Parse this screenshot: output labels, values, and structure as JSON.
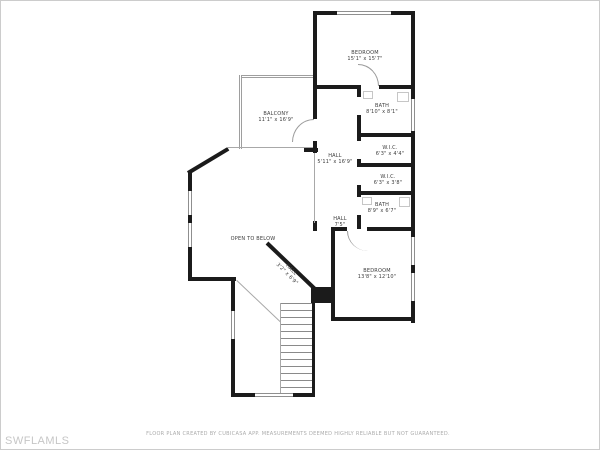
{
  "watermark": "SWFLAMLS",
  "disclaimer": "FLOOR PLAN CREATED BY CUBICASA APP. MEASUREMENTS DEEMED HIGHLY RELIABLE BUT NOT GUARANTEED.",
  "rooms": [
    {
      "id": "bedroom-upper",
      "name": "BEDROOM",
      "dims": "15'1\" x 15'7\""
    },
    {
      "id": "bath-upper",
      "name": "BATH",
      "dims": "8'10\" x 8'1\""
    },
    {
      "id": "wic-1",
      "name": "W.I.C.",
      "dims": "6'3\" x 4'4\""
    },
    {
      "id": "wic-2",
      "name": "W.I.C.",
      "dims": "6'3\" x 3'8\""
    },
    {
      "id": "bath-lower",
      "name": "BATH",
      "dims": "8'9\" x 6'7\""
    },
    {
      "id": "hall-main",
      "name": "HALL",
      "dims": "5'11\" x 16'9\""
    },
    {
      "id": "hall-small",
      "name": "HALL",
      "dims": "7'5\""
    },
    {
      "id": "bedroom-lower",
      "name": "BEDROOM",
      "dims": "13'8\" x 12'10\""
    },
    {
      "id": "balcony",
      "name": "BALCONY",
      "dims": "11'1\" x 16'9\""
    },
    {
      "id": "open-to-below",
      "name": "OPEN TO BELOW",
      "dims": ""
    },
    {
      "id": "hall-diagonal",
      "name": "HALL",
      "dims": "3'2\" x 6'9\""
    }
  ]
}
